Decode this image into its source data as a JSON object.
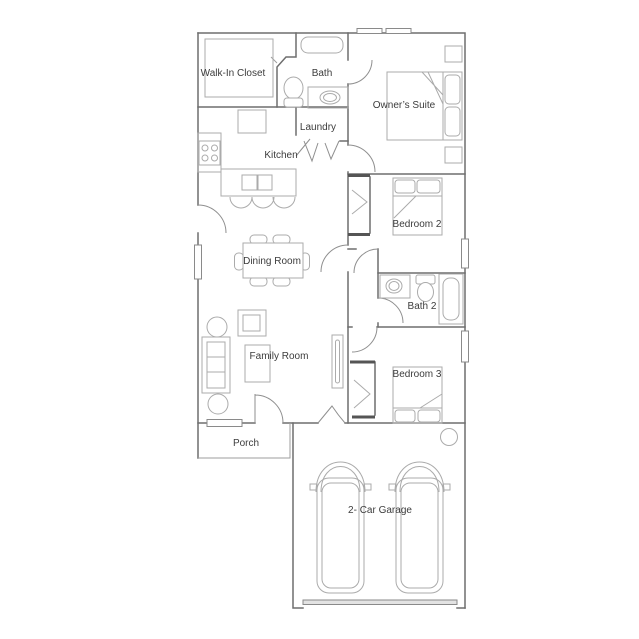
{
  "page": {
    "background": "#ffffff",
    "type": "residential floor plan"
  },
  "colors": {
    "background": "#ffffff",
    "wall": "#6e6e6e",
    "furniture": "#ababab",
    "thin": "#9e9e9e",
    "door": "#8f8f8f",
    "window_frame": "#8a8a8a",
    "dark_stub": "#555555",
    "garage_door_fill": "#e3e3e3",
    "text": "#3c3c3c"
  },
  "rooms": [
    {
      "id": "walk-in-closet",
      "label": "Walk-In Closet"
    },
    {
      "id": "bath",
      "label": "Bath"
    },
    {
      "id": "owners-suite",
      "label": "Owner’s Suite"
    },
    {
      "id": "laundry",
      "label": "Laundry"
    },
    {
      "id": "kitchen",
      "label": "Kitchen"
    },
    {
      "id": "bedroom-2",
      "label": "Bedroom 2"
    },
    {
      "id": "dining-room",
      "label": "Dining Room"
    },
    {
      "id": "bath-2",
      "label": "Bath 2"
    },
    {
      "id": "family-room",
      "label": "Family Room"
    },
    {
      "id": "bedroom-3",
      "label": "Bedroom 3"
    },
    {
      "id": "porch",
      "label": "Porch"
    },
    {
      "id": "garage",
      "label": "2- Car Garage"
    }
  ],
  "fixtures": [
    "bathtub",
    "toilet",
    "vanity-sink",
    "closet-shelving",
    "range-stove",
    "refrigerator",
    "kitchen-island-sink",
    "bar-stools",
    "dining-table-with-chairs",
    "sofa",
    "armchair",
    "side-tables",
    "coffee-table",
    "tv",
    "bed-owners",
    "bed-2",
    "bed-3",
    "nightstands",
    "closet-rods",
    "bathtub-2",
    "toilet-2",
    "vanity-sink-2",
    "water-heater",
    "car",
    "car",
    "garage-door",
    "windows",
    "door-swings"
  ]
}
